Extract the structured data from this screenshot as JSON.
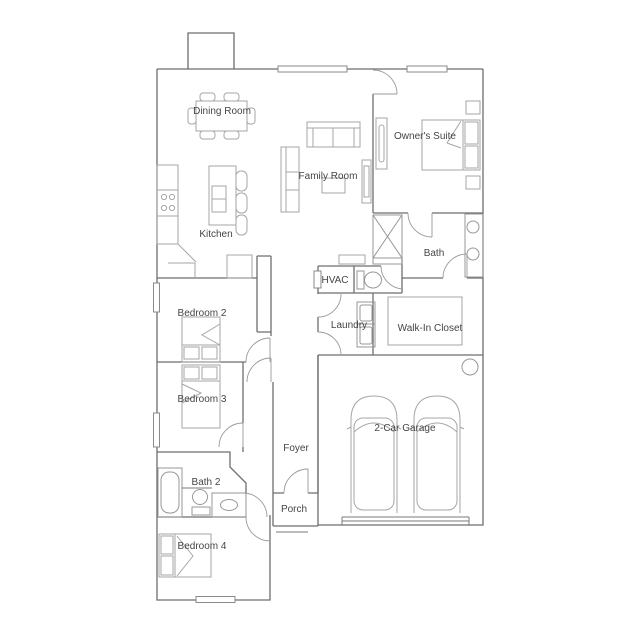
{
  "plan": {
    "type": "single-story-floor-plan",
    "colors": {
      "background": "#ffffff",
      "walls": "#6e6e6e",
      "furniture": "#a6a6a6",
      "text": "#454545"
    },
    "rooms": [
      {
        "id": "dining-room",
        "label": "Dining Room",
        "x": 222,
        "y": 114
      },
      {
        "id": "owners-suite",
        "label": "Owner's Suite",
        "x": 425,
        "y": 139
      },
      {
        "id": "family-room",
        "label": "Family Room",
        "x": 328,
        "y": 179
      },
      {
        "id": "kitchen",
        "label": "Kitchen",
        "x": 216,
        "y": 237
      },
      {
        "id": "bath",
        "label": "Bath",
        "x": 434,
        "y": 256
      },
      {
        "id": "hvac",
        "label": "HVAC",
        "x": 335,
        "y": 283
      },
      {
        "id": "laundry",
        "label": "Laundry",
        "x": 349,
        "y": 328
      },
      {
        "id": "walk-in-closet",
        "label": "Walk-In Closet",
        "x": 430,
        "y": 331
      },
      {
        "id": "bedroom-2",
        "label": "Bedroom 2",
        "x": 202,
        "y": 316
      },
      {
        "id": "bedroom-3",
        "label": "Bedroom 3",
        "x": 202,
        "y": 402
      },
      {
        "id": "two-car-garage",
        "label": "2-Car Garage",
        "x": 405,
        "y": 431
      },
      {
        "id": "foyer",
        "label": "Foyer",
        "x": 296,
        "y": 451
      },
      {
        "id": "bath-2",
        "label": "Bath 2",
        "x": 206,
        "y": 485
      },
      {
        "id": "porch",
        "label": "Porch",
        "x": 294,
        "y": 512
      },
      {
        "id": "bedroom-4",
        "label": "Bedroom 4",
        "x": 202,
        "y": 549
      }
    ],
    "symbols": [
      "dining-table",
      "kitchen-island",
      "range",
      "bed",
      "sofa",
      "loveseat",
      "coffee-table",
      "media-console",
      "dresser",
      "nightstand",
      "shower",
      "double-vanity",
      "toilet",
      "washer-dryer",
      "closet-shelving",
      "water-heater",
      "bathtub",
      "car",
      "window",
      "door-swing"
    ]
  }
}
